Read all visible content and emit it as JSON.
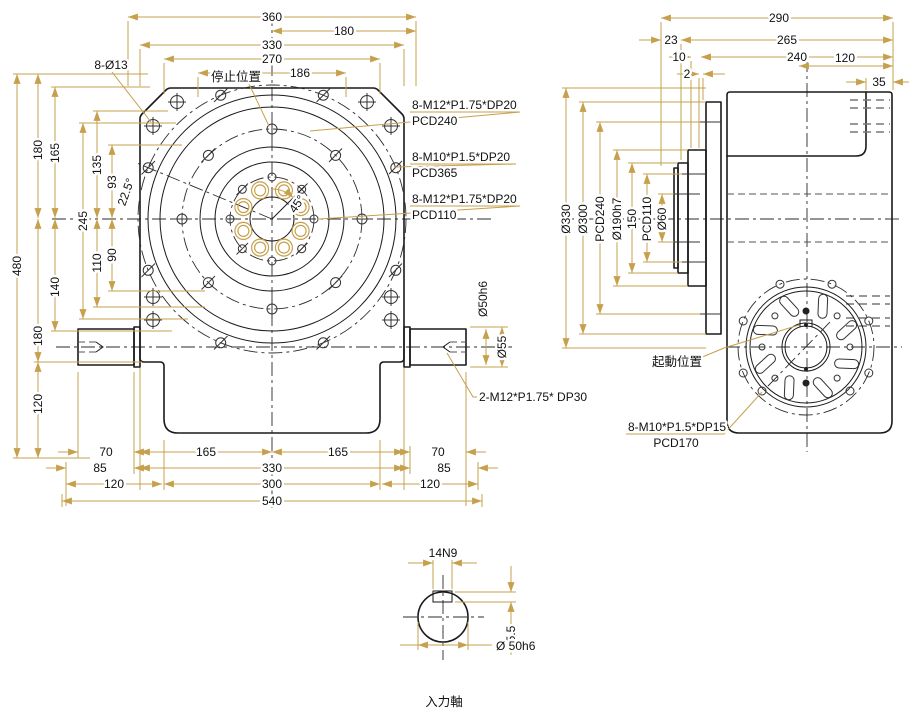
{
  "front": {
    "top": [
      "360",
      "180",
      "330",
      "270",
      "186"
    ],
    "left": [
      "480",
      "180",
      "165",
      "245",
      "135",
      "93",
      "22.5°",
      "140",
      "110",
      "90",
      "180",
      "120"
    ],
    "bottom": [
      "70",
      "165",
      "165",
      "70",
      "85",
      "330",
      "85",
      "120",
      "300",
      "120",
      "540"
    ],
    "shaft_dims": [
      "Ø50h6",
      "Ø55"
    ],
    "holes_note": "8-Ø13",
    "stop_label": "停止位置",
    "angle_45": "45°",
    "notes": [
      {
        "l1": "8-M12*P1.75*DP20",
        "l2": "PCD240"
      },
      {
        "l1": "8-M10*P1.5*DP20",
        "l2": "PCD365"
      },
      {
        "l1": "8-M12*P1.75*DP20",
        "l2": "PCD110"
      }
    ],
    "shaft_tap_note": "2-M12*P1.75*    DP30"
  },
  "side": {
    "top": [
      "290",
      "23",
      "265",
      "10",
      "240",
      "2",
      "120",
      "35"
    ],
    "left": [
      "Ø330",
      "Ø300",
      "PCD240",
      "Ø190h7",
      "150",
      "PCD110",
      "Ø60"
    ],
    "start_label": "起動位置",
    "tap_note": {
      "l1": "8-M10*P1.5*DP15",
      "l2": "PCD170"
    }
  },
  "detail": {
    "key_width": "14N9",
    "key_depth": "5.5",
    "dia": "Ø 50h6",
    "title": "入力軸"
  },
  "colors": {
    "line": "#1a1a1a",
    "dimension": "#c6a04c",
    "background": "#ffffff"
  }
}
